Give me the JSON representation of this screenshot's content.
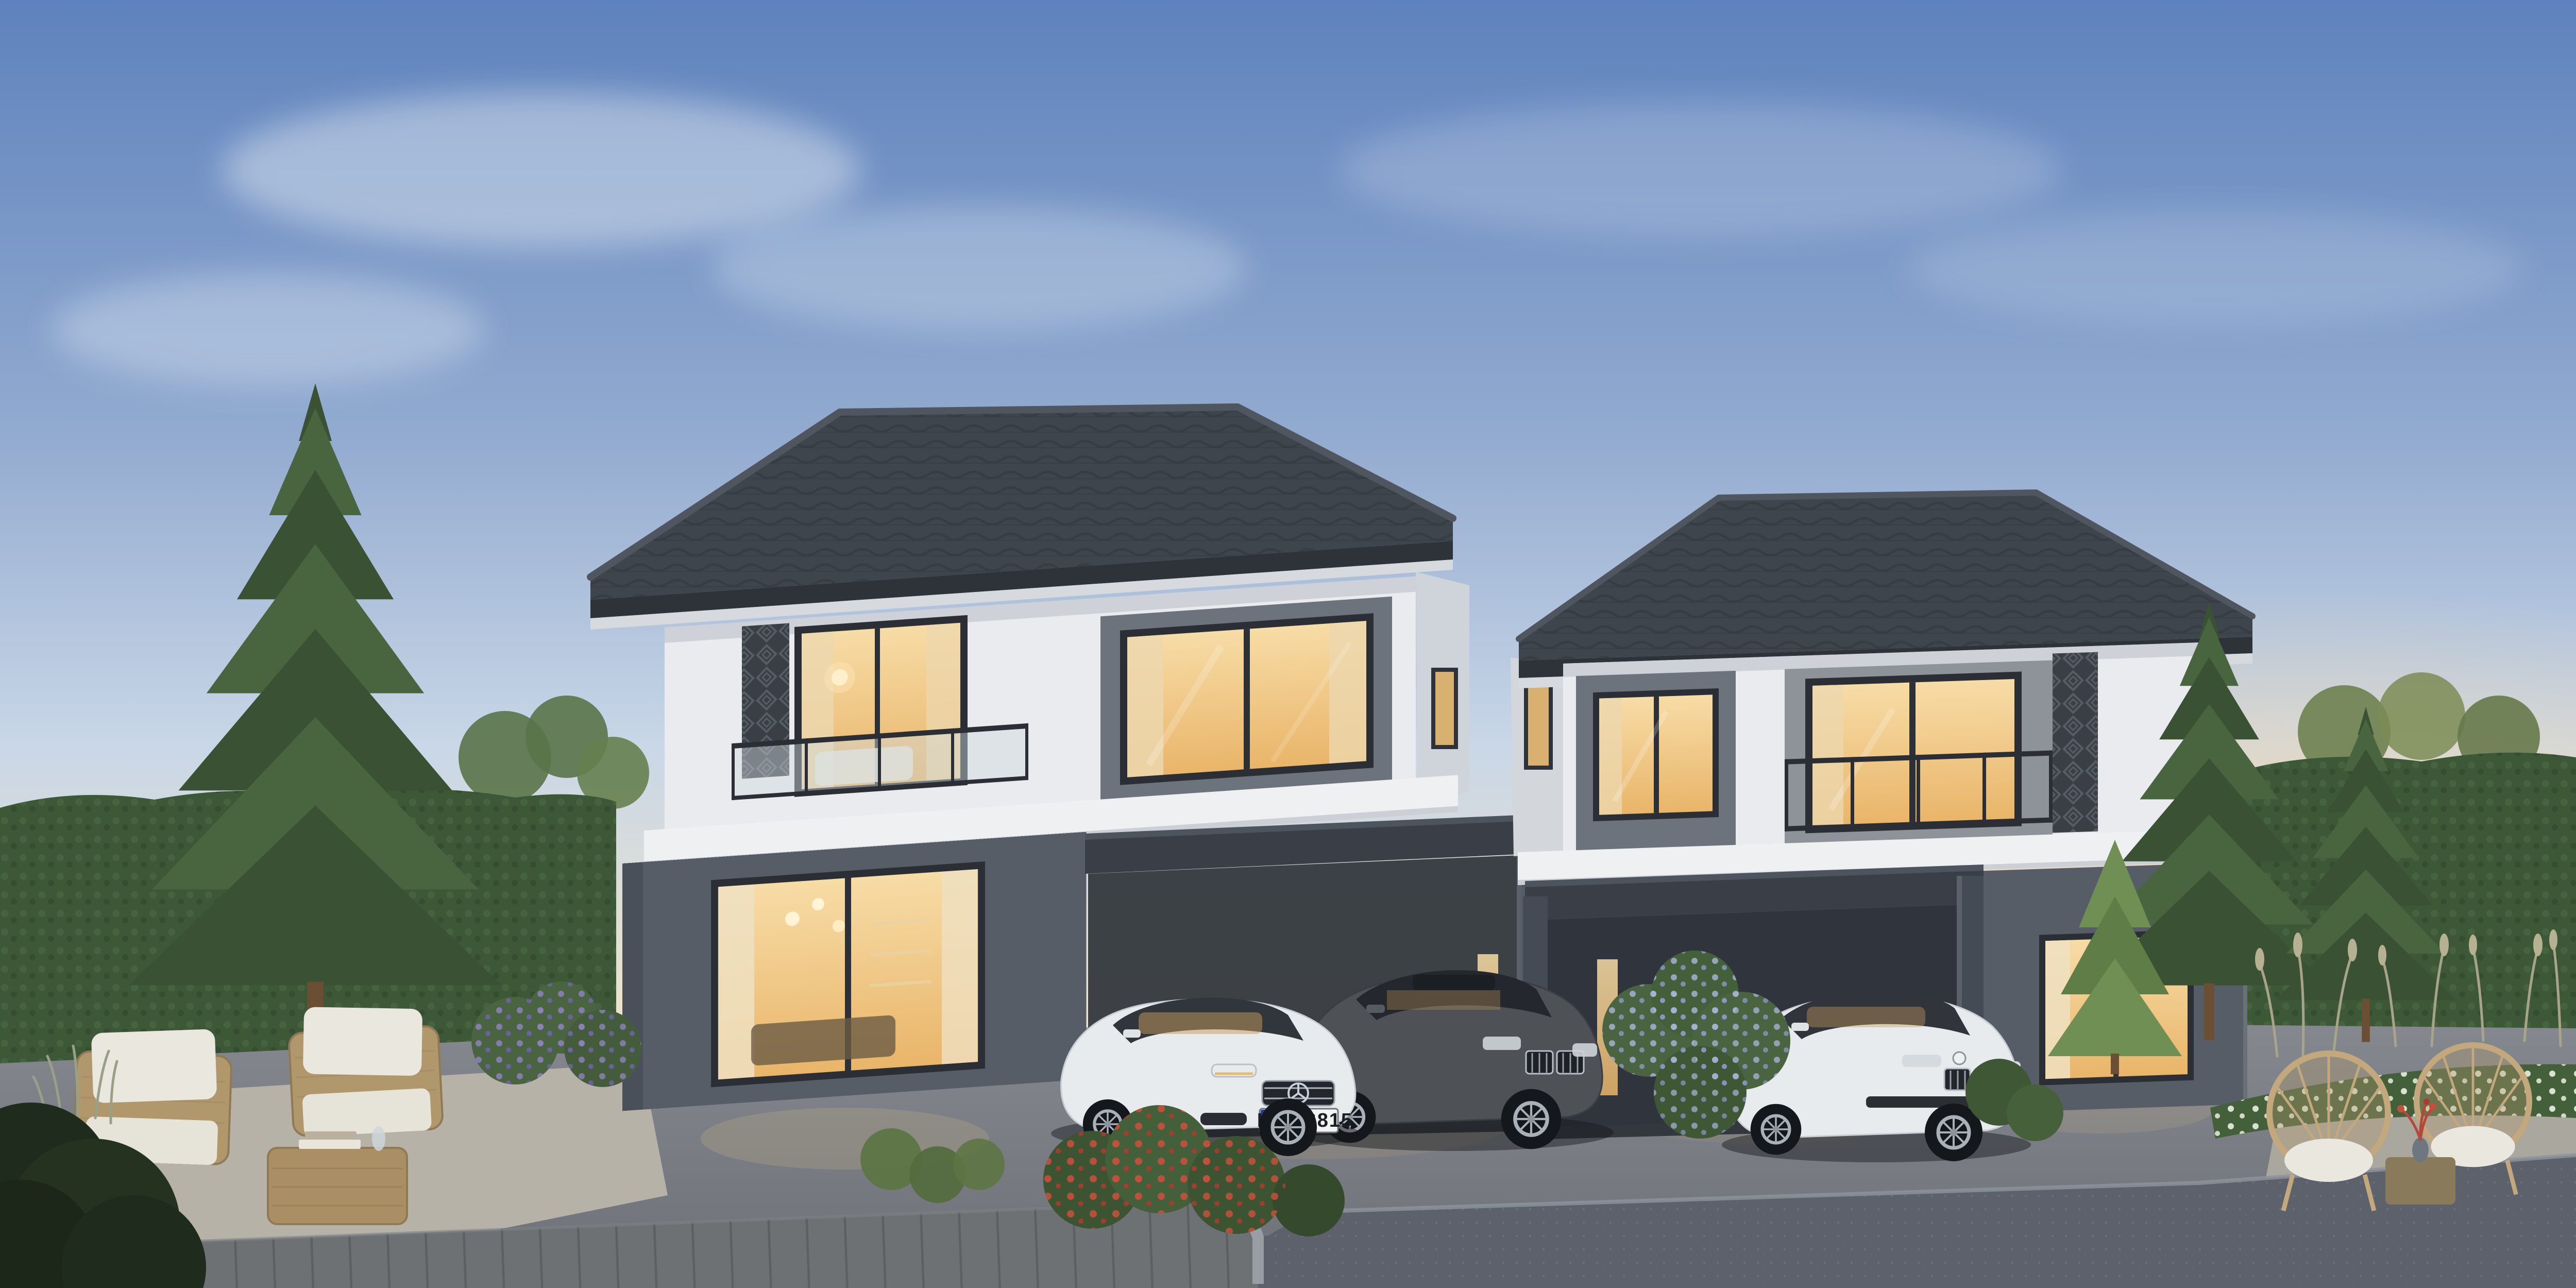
{
  "scene": {
    "type": "photorealistic exterior rendering",
    "time_of_day": "dusk",
    "setting": "two modern two-storey houses with carports, parked cars, landscaped garden, paved driveway and street",
    "license_plate": {
      "country_band": "D",
      "number": "IN A 6815"
    },
    "houses": [
      {
        "label": "left-house",
        "features": "hip tile roof, white upper storey, graphite lower storey, balcony with glass railing and laser-cut screen, lit interiors, carport"
      },
      {
        "label": "right-house",
        "features": "hip tile roof, white upper storey, graphite lower storey, recessed balcony with laser-cut screen, lit interiors, carport"
      }
    ],
    "cars": [
      {
        "label": "graphite-bmw-sedan"
      },
      {
        "label": "white-mercedes-sedan",
        "plate": "IN A 6815"
      },
      {
        "label": "white-bmw-sedan"
      }
    ],
    "vegetation": [
      "tall spruce trees",
      "clipped hedge walls",
      "purple flower bush",
      "red flower bush",
      "lilac flower bush",
      "white flower beds",
      "ornamental grasses"
    ],
    "furniture": [
      "wicker lounge chairs with white cushions",
      "wicker coffee table with books and carafe",
      "rattan peacock chairs with side table and red flowers"
    ]
  },
  "colors": {
    "sky_top": "#5e82bd",
    "sky_mid": "#93abd0",
    "sky_low": "#c9d7e7",
    "sky_horizon": "#efe3c9",
    "sky_horizon_deep": "#f6ead0",
    "sun_glow": "#ffd9a0",
    "cloud": "#e6edf5",
    "roof": "#3f454d",
    "roof_ridge": "#50565f",
    "soffit": "#d6dade",
    "wall_white": "#e9ebee",
    "wall_shade": "#cfd4da",
    "wall_gray_panel": "#6d737c",
    "wall_dark": "#575d66",
    "band_white": "#eef0f2",
    "window_frame": "#2b2f35",
    "glow_top": "#f7dca6",
    "glow_bottom": "#e9b56a",
    "curtain": "#ecd7ae",
    "screen_dark": "#3a3f46",
    "hedge": "#3d5837",
    "spruce": "#49653f",
    "spruce_dark": "#3a5233",
    "trunk": "#6b4f35",
    "conifer_bright": "#6f8f54",
    "grass_tan": "#a8a489",
    "flower_purple": "#8d82bd",
    "flower_red": "#c4503c",
    "flower_white": "#e9efe2",
    "flower_lilac": "#aab4d8",
    "shrub_green": "#3c5431",
    "wicker": "#b1976c",
    "cushion": "#eae7de",
    "rattan": "#c2a87c",
    "wood": "#8a7a5c",
    "ground_light": "#85898f",
    "ground_dark": "#6d7177",
    "patio_pad": "#b7b2a8",
    "deck": "#6e7174",
    "road": "#5c616b",
    "curb": "#9aa0a6",
    "car_white": "#e8ebed",
    "car_dark": "#4e5257",
    "glass_dark": "#2b3036",
    "plate_blue": "#1a3f9e",
    "plate_text": "#1b1e22",
    "shadow": "#14171b"
  }
}
